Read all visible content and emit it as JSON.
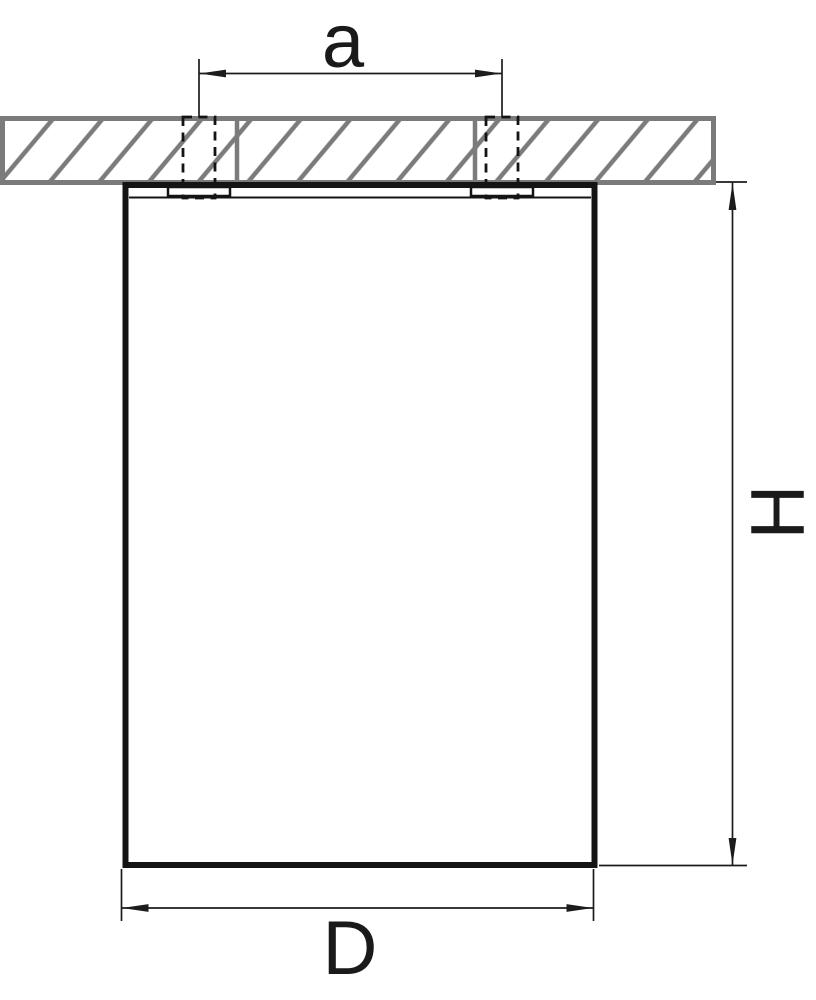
{
  "drawing": {
    "type": "technical-dimension-drawing",
    "dimensions": {
      "hole_spacing": {
        "label": "a"
      },
      "height": {
        "label": "H"
      },
      "diameter": {
        "label": "D"
      }
    },
    "colors": {
      "line": "#1a1a1a",
      "hatch_gray": "#7b7b7b",
      "background": "#ffffff"
    }
  }
}
